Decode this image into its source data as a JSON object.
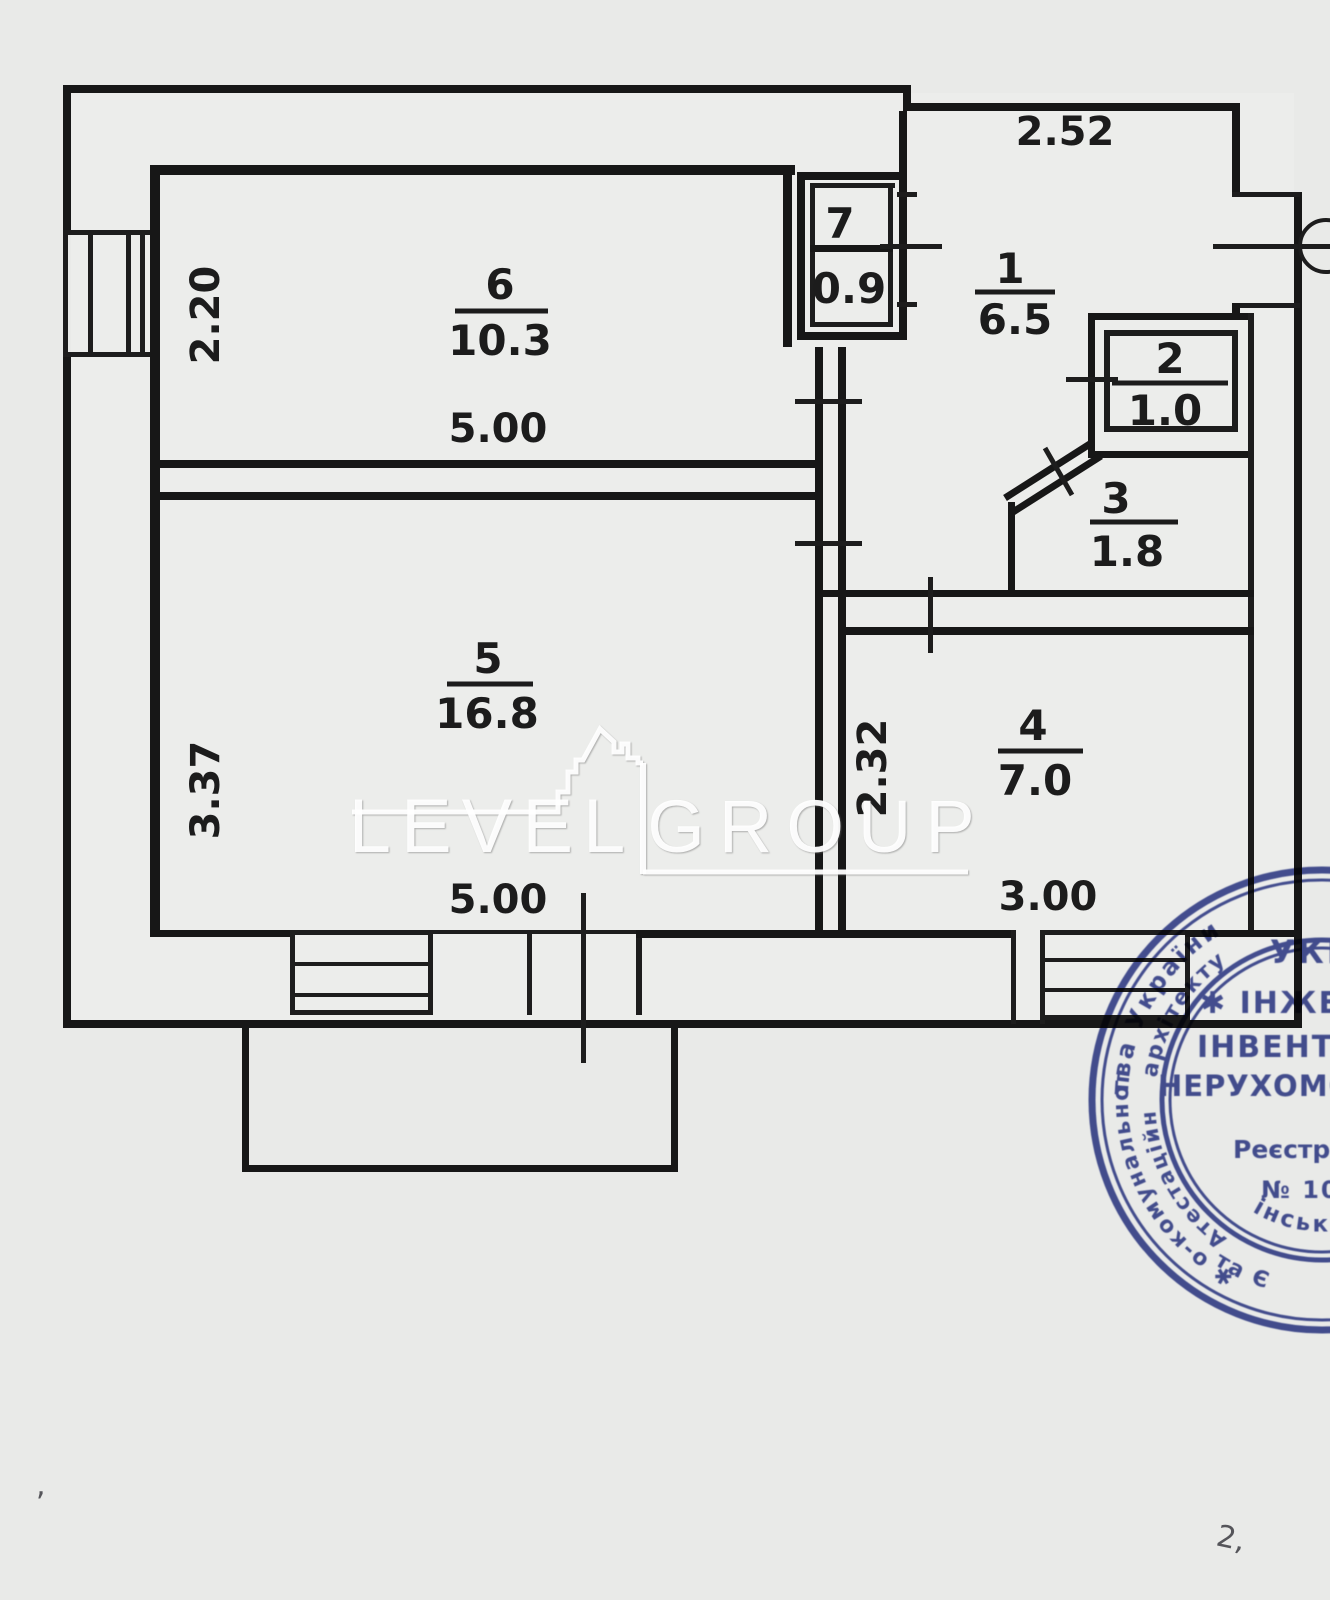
{
  "document": {
    "kind": "apartment floor plan scan"
  },
  "rooms": [
    {
      "number": "1",
      "area": "6.5"
    },
    {
      "number": "2",
      "area": "1.0"
    },
    {
      "number": "3",
      "area": "1.8"
    },
    {
      "number": "4",
      "area": "7.0"
    },
    {
      "number": "5",
      "area": "16.8"
    },
    {
      "number": "6",
      "area": "10.3"
    },
    {
      "number": "7",
      "area": "0.9"
    }
  ],
  "dimensions": {
    "room1_top": "2.52",
    "room6_left": "2.20",
    "room6_bottom": "5.00",
    "room5_left": "3.37",
    "room5_bottom": "5.00",
    "room4_left": "2.32",
    "room4_bottom": "3.00"
  },
  "watermark": {
    "brand_left": "LEVEL",
    "brand_right": "GROUP"
  },
  "stamp": {
    "ink_color": "#2e3a8c",
    "center_lines": [
      "УКР",
      "✱ ІНЖЕ",
      "ІНВЕНТА",
      "НЕРУХОМО",
      "Реєстра",
      "№ 10"
    ],
    "arc_top_outer": "тва України",
    "arc_top_inner": "архітекту",
    "arc_left_outer": "✱ о-комунального господ",
    "arc_left_inner": "Атестаційн",
    "arc_bottom_inner": "інський ВАДИМ",
    "arc_bottom_outer_a": "та Є",
    "arc_bottom_outer_b": "сертиф"
  },
  "artifacts": {
    "bottom_left": ",",
    "bottom_right": "2,"
  }
}
